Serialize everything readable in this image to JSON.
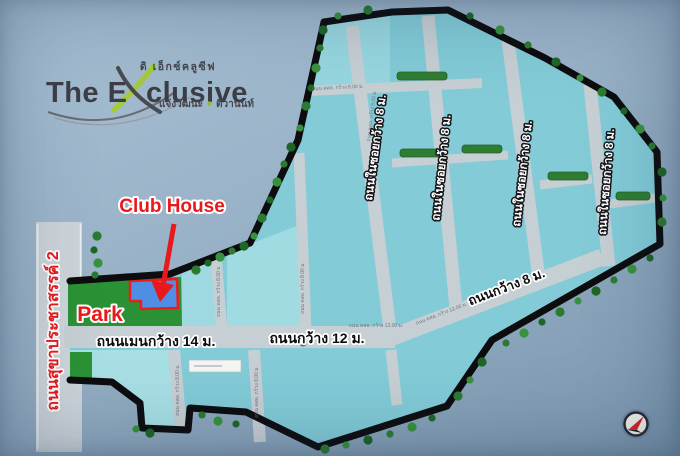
{
  "sign": {
    "project_name_prefix": "The E",
    "project_name_suffix": "clusive",
    "thai_name_top": "ดิ เอ็กซ์คลูซีฟ",
    "thai_subtitle_left": "แจ้งวัฒนะ",
    "thai_subtitle_right": "ติวานนท์"
  },
  "labels": {
    "club_house": "Club House",
    "park": "Park",
    "public_road": "ถนนสุขาประชาสรรค์ 2",
    "main_road": "ถนนเมนกว้าง 14 ม.",
    "road_12m": "ถนนกว้าง 12 ม.",
    "road_8m": "ถนนกว้าง 8 ม.",
    "soi_road": "ถนนในซอยกว้าง 8 ม.",
    "annotation_8m": "ถนน คสล. กว้าง 8.00 ม.",
    "annotation_12m": "ถนน คสล. กว้าง 12.00 ม."
  },
  "colors": {
    "accent_red": "#e8191c",
    "plot_cyan": "#82cbd7",
    "park_green": "#2a9235",
    "road_gray": "#c6cfd3",
    "clubhouse_blue": "#4e8ee4",
    "boundary_black": "#0d0d0f",
    "logo_green": "#a6ca3d"
  }
}
